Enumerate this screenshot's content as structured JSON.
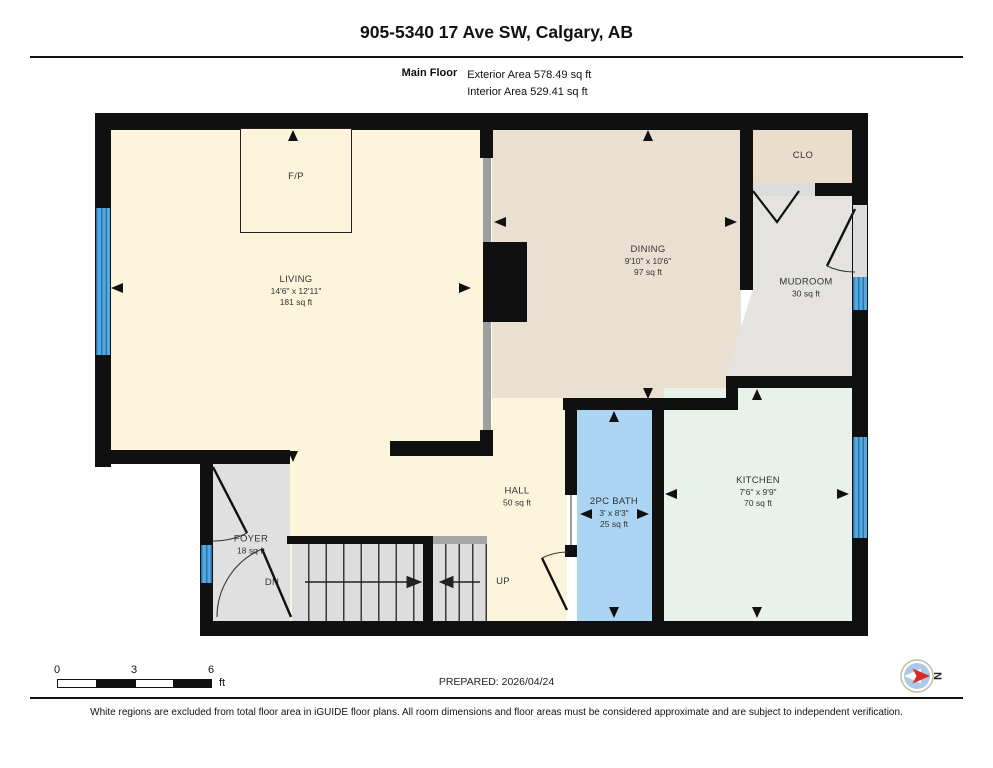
{
  "header": {
    "title": "905-5340 17 Ave SW, Calgary, AB",
    "floor_label": "Main Floor",
    "exterior_area": "Exterior Area 578.49 sq ft",
    "interior_area": "Interior Area 529.41 sq ft"
  },
  "rooms": {
    "living": {
      "name": "LIVING",
      "dims": "14'6\" x 12'11\"",
      "area": "181 sq ft"
    },
    "dining": {
      "name": "DINING",
      "dims": "9'10\" x 10'6\"",
      "area": "97 sq ft"
    },
    "kitchen": {
      "name": "KITCHEN",
      "dims": "7'6\" x 9'9\"",
      "area": "70 sq ft"
    },
    "bath": {
      "name": "2PC BATH",
      "dims": "3' x 8'3\"",
      "area": "25 sq ft"
    },
    "mudroom": {
      "name": "MUDROOM",
      "area": "30 sq ft"
    },
    "hall": {
      "name": "HALL",
      "area": "50 sq ft"
    },
    "foyer": {
      "name": "FOYER",
      "area": "18 sq ft"
    },
    "closet": {
      "name": "CLO"
    },
    "fireplace": {
      "name": "F/P"
    },
    "stairs_down_label": "DN",
    "stairs_up_label": "UP"
  },
  "scale_bar": {
    "ticks": [
      "0",
      "3",
      "6"
    ],
    "unit": "ft"
  },
  "footer": {
    "prepared": "PREPARED: 2026/04/24",
    "disclaimer": "White regions are excluded from total floor area in iGUIDE floor plans. All room dimensions and floor areas must be considered approximate and are subject to independent verification.",
    "compass_label": "N"
  },
  "colors": {
    "living": "#FCF5DB",
    "dining": "#EAE0D2",
    "closet": "#EADDCB",
    "mudroom": "#E4E3E0",
    "kitchen": "#E8F1EA",
    "bath": "#ABD5F3",
    "hall": "#FCF5DB",
    "foyer": "#E0E0E0",
    "stairs": "#DDDDDD",
    "window": "#4BA5DE",
    "wall": "#101010"
  }
}
